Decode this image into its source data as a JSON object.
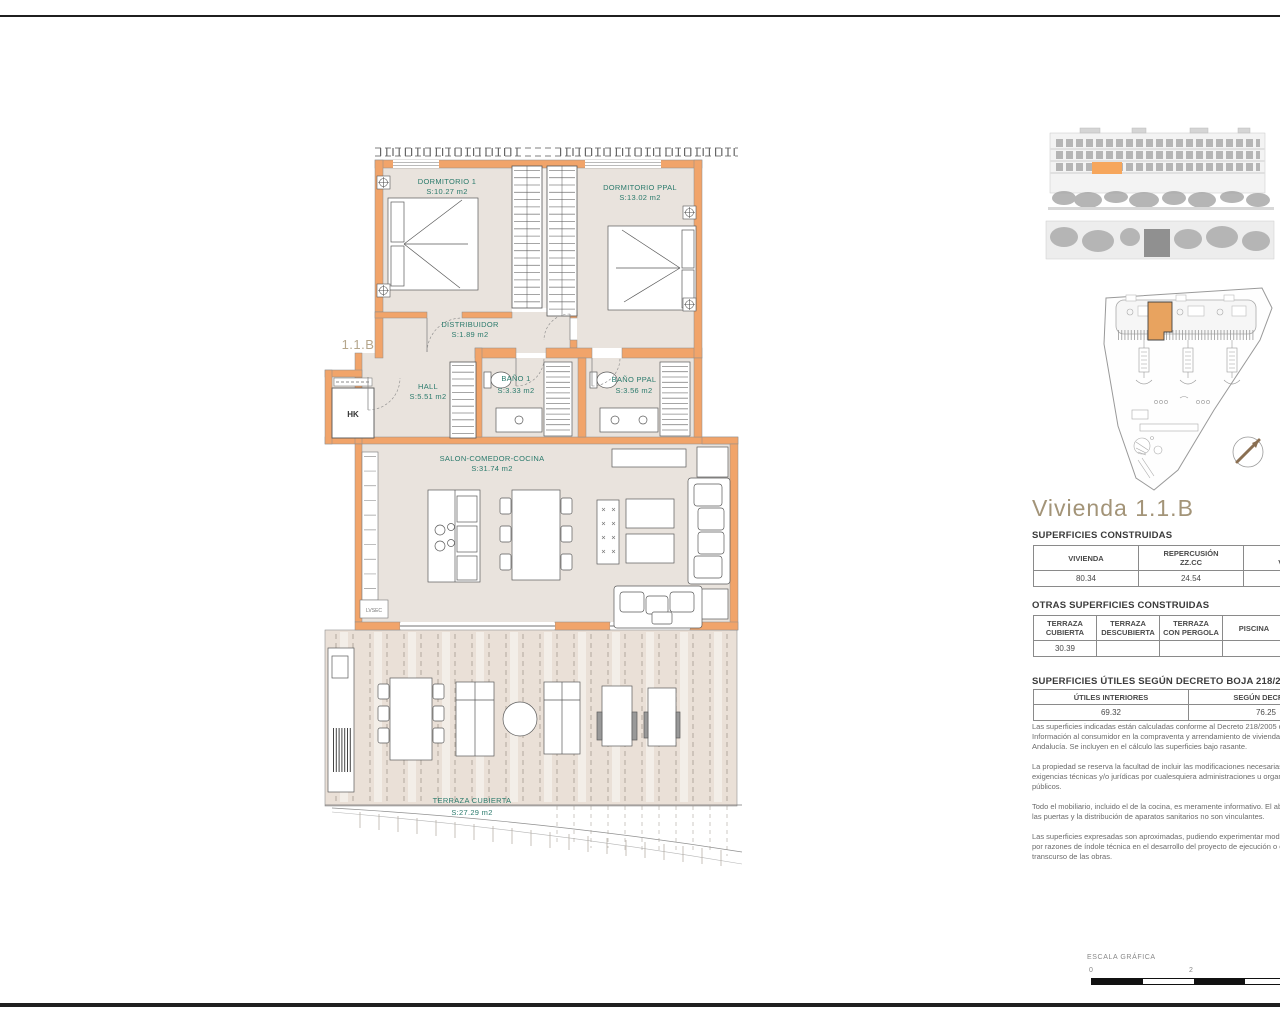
{
  "colors": {
    "wall_accent": "#f1a46a",
    "room_label_teal": "#2a7a6c",
    "title_tan": "#a39478",
    "unit_highlight": "#eda55e"
  },
  "plan": {
    "unit_label": "1.1.B",
    "hk_label": "HK",
    "appliance_label": "LVSEC",
    "rooms": [
      {
        "name": "DORMITORIO 1",
        "area": "S:10.27 m2"
      },
      {
        "name": "DORMITORIO PPAL",
        "area": "S:13.02 m2"
      },
      {
        "name": "DISTRIBUIDOR",
        "area": "S:1.89 m2"
      },
      {
        "name": "HALL",
        "area": "S:5.51 m2"
      },
      {
        "name": "BAÑO 1",
        "area": "S:3.33 m2"
      },
      {
        "name": "BAÑO PPAL",
        "area": "S:3.56 m2"
      },
      {
        "name": "SALON-COMEDOR-COCINA",
        "area": "S:31.74 m2"
      },
      {
        "name": "TERRAZA CUBIERTA",
        "area": "S:27.29 m2"
      }
    ]
  },
  "panel": {
    "title": "Vivienda 1.1.B",
    "tables": [
      {
        "label": "SUPERFICIES CONSTRUIDAS",
        "headers": [
          "VIVIENDA",
          "REPERCUSIÓN\nZZ.CC",
          "TOTAL\nVIVIENDA"
        ],
        "values": [
          "80.34",
          "24.54",
          "104.88"
        ]
      },
      {
        "label": "OTRAS SUPERFICIES CONSTRUIDAS",
        "headers": [
          "TERRAZA\nCUBIERTA",
          "TERRAZA\nDESCUBIERTA",
          "TERRAZA\nCON PERGOLA",
          "PISCINA",
          ""
        ],
        "values": [
          "30.39",
          "",
          "",
          "",
          ""
        ]
      },
      {
        "label": "SUPERFICIES ÚTILES SEGÚN DECRETO BOJA 218/2005",
        "headers": [
          "ÚTILES INTERIORES",
          "SEGÚN DECRETO"
        ],
        "values": [
          "69.32",
          "76.25"
        ]
      }
    ],
    "notes": [
      "Las superficies indicadas están calculadas conforme al Decreto 218/2005 de\nInformación al consumidor en la compraventa y arrendamiento de viviendas en\nAndalucía. Se incluyen en el cálculo las superficies bajo rasante.",
      "La propiedad se reserva la facultad de incluir las modificaciones necesarias por\nexigencias técnicas y/o jurídicas por cualesquiera administraciones u organismos\npúblicos.",
      "Todo el mobiliario, incluido el de la cocina, es meramente informativo. El abatimiento de\nlas puertas y la distribución de aparatos sanitarios no son vinculantes.",
      "Las superficies expresadas son aproximadas, pudiendo experimentar modificaciones\npor razones de índole técnica en el desarrollo del proyecto de ejecución o en el\ntranscurso de las obras."
    ],
    "scale": {
      "label": "ESCALA GRÁFICA",
      "ticks": [
        "0",
        "2"
      ]
    }
  }
}
